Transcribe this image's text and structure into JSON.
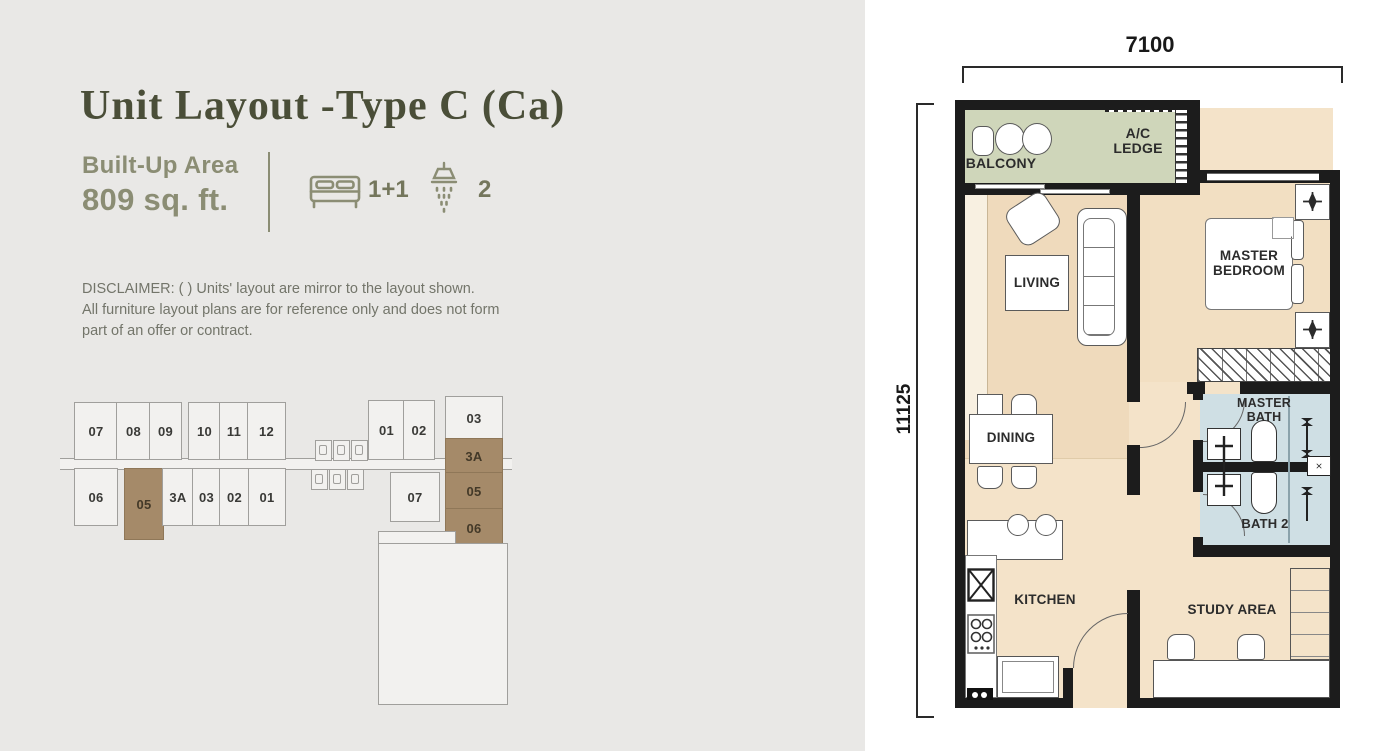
{
  "page": {
    "title": "Unit Layout -Type C (Ca)",
    "built_up_label": "Built-Up Area",
    "built_up_value": "809 sq. ft.",
    "bed_count": "1+1",
    "shower_count": "2",
    "disclaimer_lines": [
      "DISCLAIMER: ( ) Units' layout are mirror to the layout shown.",
      "All furniture layout plans are for reference only and does not form",
      "part of an offer or contract."
    ]
  },
  "keyplan": {
    "row_upper": [
      "07",
      "08",
      "09",
      "10",
      "11",
      "12"
    ],
    "row_lower": [
      "06",
      "05",
      "3A",
      "03",
      "02",
      "01"
    ],
    "right_pair": [
      "01",
      "02"
    ],
    "right_unit": "07",
    "right_column": [
      "03",
      "3A",
      "05",
      "06"
    ],
    "highlighted_units": [
      "05",
      "3A",
      "05",
      "06"
    ],
    "highlight_color": "#a58a69"
  },
  "floorplan": {
    "dim_top": "7100",
    "dim_left": "11125",
    "rooms": {
      "balcony": "BALCONY",
      "ac_ledge": "A/C LEDGE",
      "living": "LIVING",
      "master_bedroom": "MASTER BEDROOM",
      "dining": "DINING",
      "master_bath": "MASTER BATH",
      "bath_2": "BATH 2",
      "kitchen": "KITCHEN",
      "study_area": "STUDY AREA"
    },
    "colors": {
      "wall": "#1c1c1c",
      "floor": "#f4e3c9",
      "living_floor": "#efdabc",
      "balcony": "#cfd6ba",
      "bath": "#cfdfe4"
    }
  },
  "theme": {
    "accent_olive": "#8b8d74",
    "title_color": "#4a4e38",
    "left_bg": "#e9e8e6",
    "panel_bg": "#ffffff"
  }
}
